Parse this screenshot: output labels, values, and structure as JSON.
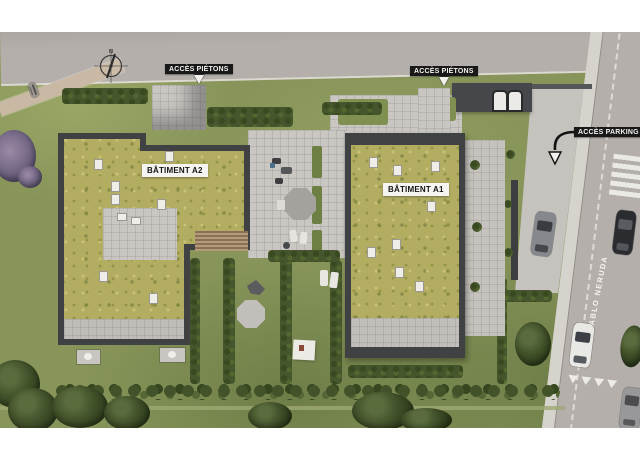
{
  "labels": {
    "pedestrian_access_1": "ACCÈS PIÉTONS",
    "pedestrian_access_2": "ACCÈS PIÉTONS",
    "parking_access": "ACCÈS PARKING",
    "building_a2": "BÂTIMENT A2",
    "building_a1": "BÂTIMENT A1",
    "street_name": "RUE PABLO NERUDA",
    "compass_north": "N"
  },
  "colors": {
    "grass": "#87955a",
    "grass_dark": "#6f8046",
    "road": "#b4afaa",
    "sidewalk": "#d6d2cc",
    "path": "#c8b8a4",
    "paving": "#cac7c2",
    "building_wall": "#3f4143",
    "green_roof": "#b3ad62",
    "hedge": "#45552c",
    "tree": "#3a4a26",
    "label_dark_bg": "#191919",
    "label_light_bg": "#f6f4f0",
    "marking_white": "#f2f0ec"
  }
}
